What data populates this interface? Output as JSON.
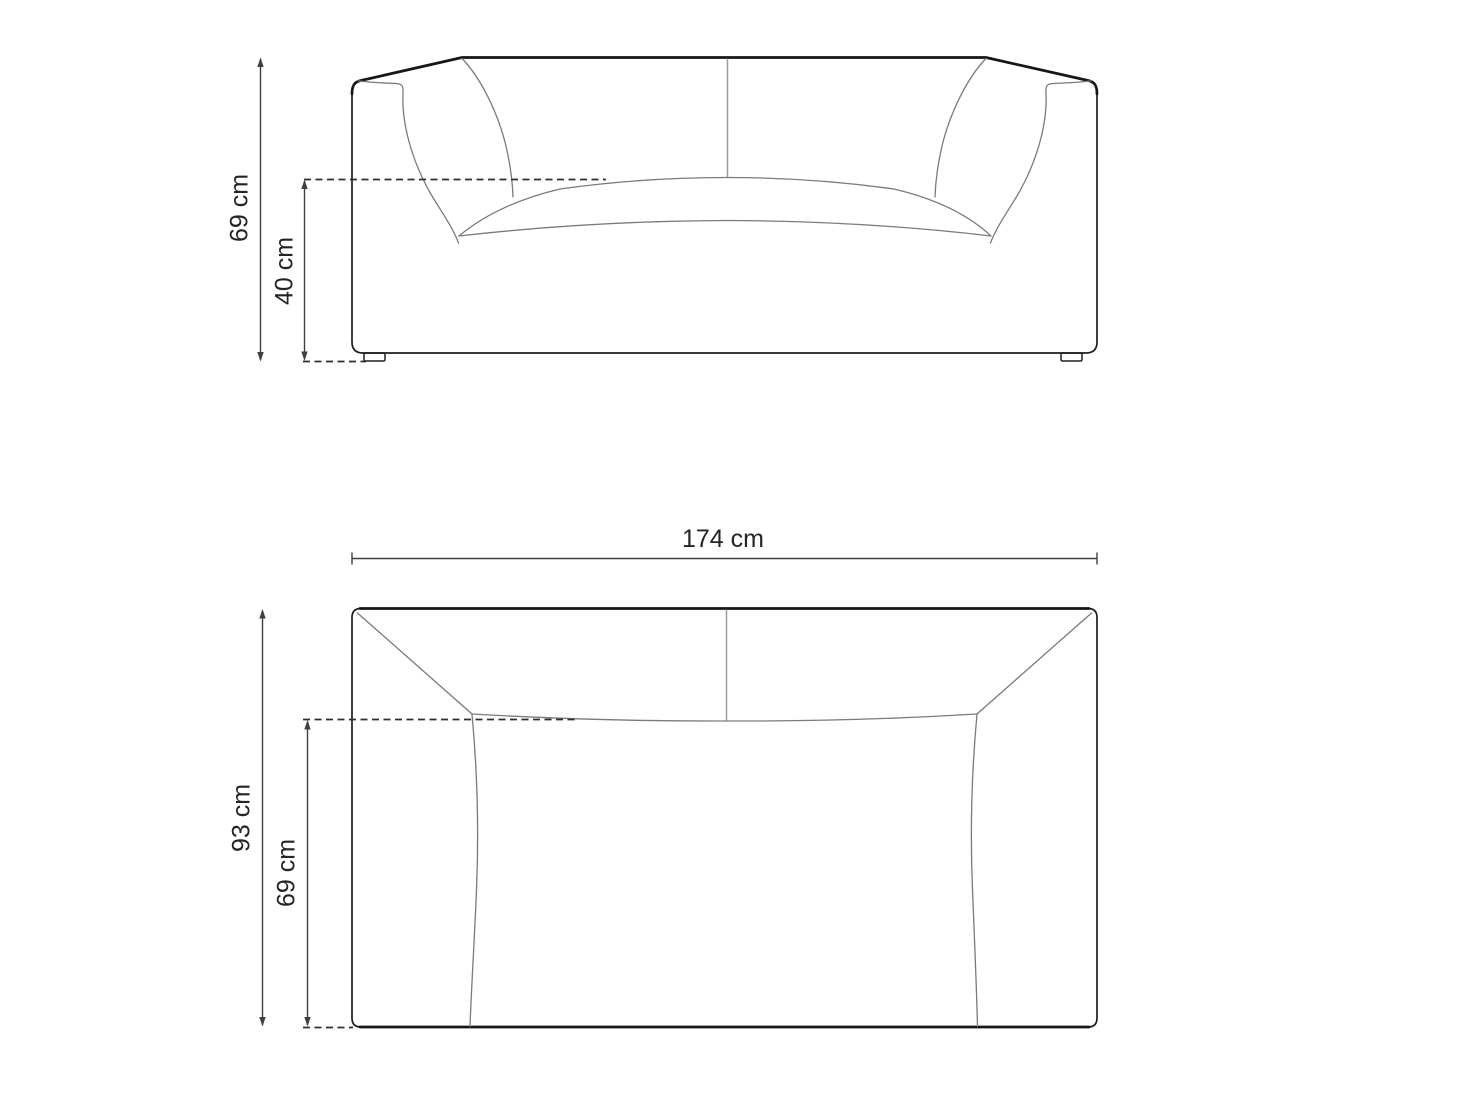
{
  "front_view": {
    "overall_height_label": "69 cm",
    "seat_height_label": "40 cm"
  },
  "top_view": {
    "width_label": "174 cm",
    "overall_depth_label": "93 cm",
    "seat_depth_label": "69 cm"
  },
  "colors": {
    "background": "#ffffff",
    "outline": "#1e1e1e",
    "contour": "#7a7a7a",
    "dimension": "#3f3f3f"
  }
}
